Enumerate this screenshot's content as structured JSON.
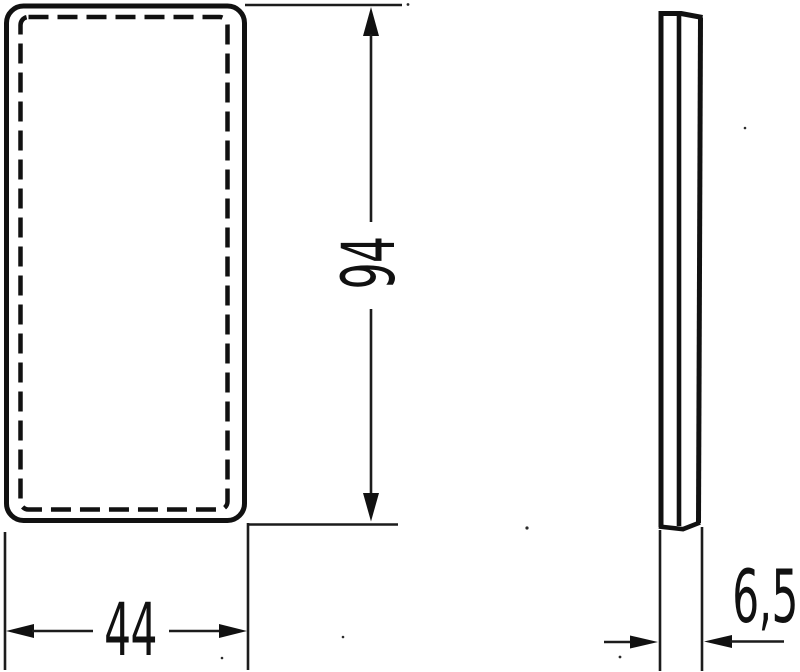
{
  "drawing": {
    "background_color": "#ffffff",
    "line_color": "#111111",
    "dimensions": {
      "height": {
        "label": "94",
        "value": 94
      },
      "width": {
        "label": "44",
        "value": 44
      },
      "depth": {
        "label": "6,5",
        "value": 6.5
      }
    }
  }
}
